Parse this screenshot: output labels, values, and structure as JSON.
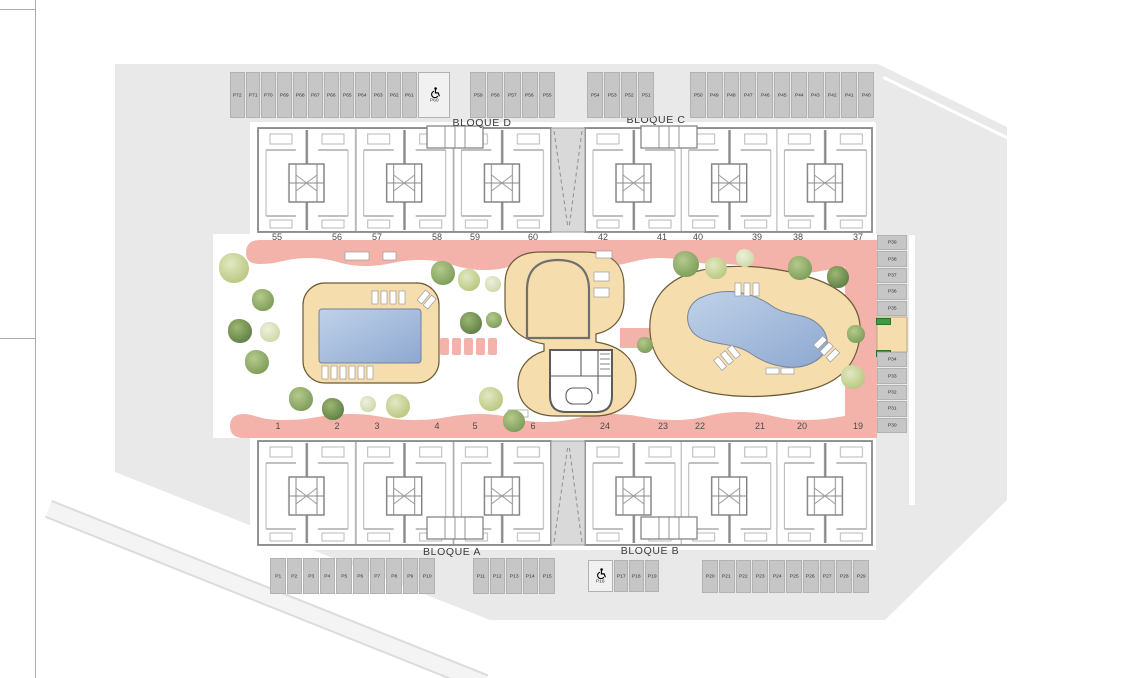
{
  "plan": {
    "block_labels": {
      "d": "BLOQUE D",
      "c": "BLOQUE C",
      "a": "BLOQUE A",
      "b": "BLOQUE B"
    },
    "parking": {
      "top_left_row": [
        "P72",
        "P71",
        "P70",
        "P69",
        "P68",
        "P67",
        "P66",
        "P65",
        "P64",
        "P63",
        "P62",
        "P61"
      ],
      "top_accessible": "P60",
      "top_mid_row": [
        "P59",
        "P58",
        "P57",
        "P56",
        "P55"
      ],
      "top_right_small": [
        "P54",
        "P53",
        "P52",
        "P51"
      ],
      "top_right_row": [
        "P50",
        "P49",
        "P48",
        "P47",
        "P46",
        "P45",
        "P44",
        "P43",
        "P42",
        "P41",
        "P40"
      ],
      "right_column_upper": [
        "P39",
        "P38",
        "P37",
        "P36",
        "P35"
      ],
      "right_column_lower": [
        "P34",
        "P33",
        "P32",
        "P31",
        "P30"
      ],
      "bottom_left_row": [
        "P1",
        "P2",
        "P3",
        "P4",
        "P5",
        "P6",
        "P7",
        "P8",
        "P9",
        "P10"
      ],
      "bottom_mid_row": [
        "P11",
        "P12",
        "P13",
        "P14",
        "P15"
      ],
      "bottom_accessible": "P16",
      "bottom_mid_row2": [
        "P17",
        "P18",
        "P19"
      ],
      "bottom_right_row": [
        "P20",
        "P21",
        "P22",
        "P23",
        "P24",
        "P25",
        "P26",
        "P27",
        "P28",
        "P29"
      ]
    },
    "unit_numbers_top": [
      "55",
      "56",
      "57",
      "58",
      "59",
      "60",
      "42",
      "41",
      "40",
      "39",
      "38",
      "37"
    ],
    "unit_numbers_bottom": [
      "1",
      "2",
      "3",
      "4",
      "5",
      "6",
      "24",
      "23",
      "22",
      "21",
      "20",
      "19"
    ],
    "colors": {
      "site": "#e9e9e9",
      "stall": "#c6c6c6",
      "path_pink": "#f3b3ab",
      "deck_tan": "#f6ddae",
      "pool_light": "#bccfe8",
      "pool_dark": "#8ea8d0"
    }
  }
}
